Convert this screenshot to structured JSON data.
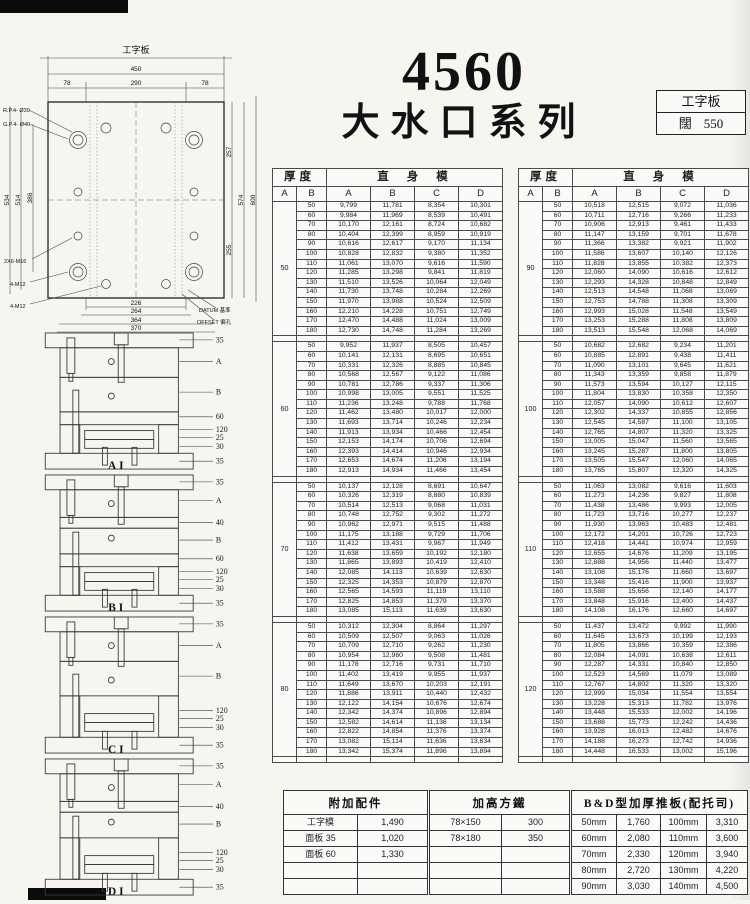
{
  "page_title": {
    "model": "4560",
    "series": "大水口系列"
  },
  "info_box": {
    "type": "工字板",
    "width_label": "闊",
    "width_value": "550"
  },
  "plate_drawing": {
    "title": "工字板",
    "dims_top": [
      "450",
      "78",
      "290",
      "78"
    ],
    "dims_bottom": [
      "226",
      "264",
      "364",
      "370"
    ],
    "dims_left": [
      "534",
      "514",
      "386"
    ],
    "dims_right": [
      "257",
      "255",
      "574",
      "600"
    ],
    "annotations": {
      "return_pin": "R.P.4- Ø30",
      "guide_pin": "G.P.4- Ø40",
      "m16": "2X6-M16",
      "m12_a": "4-M12",
      "m12_b": "4-M12",
      "datum": "DATUM 基準",
      "offset": "OFFSET 偏孔"
    }
  },
  "mold_diagrams": [
    {
      "label": "AI",
      "callouts": [
        "35",
        "A",
        "B",
        "60",
        "120",
        "25",
        "30",
        "35"
      ]
    },
    {
      "label": "BI",
      "callouts": [
        "35",
        "A",
        "40",
        "B",
        "60",
        "120",
        "25",
        "30",
        "35"
      ]
    },
    {
      "label": "CI",
      "callouts": [
        "35",
        "A",
        "B",
        "120",
        "25",
        "30",
        "35"
      ]
    },
    {
      "label": "DI",
      "callouts": [
        "35",
        "A",
        "40",
        "B",
        "120",
        "25",
        "30",
        "35"
      ]
    }
  ],
  "size_tables": [
    {
      "header_thickness": "厚度",
      "header_body": "直身模",
      "col_headers": [
        "A",
        "B",
        "A",
        "B",
        "C",
        "D"
      ],
      "blocks": [
        {
          "a": "50",
          "rows": [
            [
              "50",
              "9,799",
              "11,781",
              "8,354",
              "10,301"
            ],
            [
              "60",
              "9,984",
              "11,969",
              "8,539",
              "10,491"
            ],
            [
              "70",
              "10,170",
              "12,161",
              "8,724",
              "10,682"
            ],
            [
              "80",
              "10,404",
              "12,399",
              "8,959",
              "10,919"
            ],
            [
              "90",
              "10,616",
              "12,617",
              "9,170",
              "11,134"
            ],
            [
              "100",
              "10,828",
              "12,832",
              "9,380",
              "11,352"
            ],
            [
              "110",
              "11,061",
              "13,070",
              "9,616",
              "11,590"
            ],
            [
              "120",
              "11,285",
              "13,298",
              "9,841",
              "11,819"
            ],
            [
              "130",
              "11,510",
              "13,526",
              "10,064",
              "12,049"
            ],
            [
              "140",
              "11,730",
              "13,748",
              "10,284",
              "12,269"
            ],
            [
              "150",
              "11,970",
              "13,988",
              "10,524",
              "12,509"
            ],
            [
              "160",
              "12,210",
              "14,228",
              "10,751",
              "12,749"
            ],
            [
              "170",
              "12,470",
              "14,488",
              "11,024",
              "13,009"
            ],
            [
              "180",
              "12,730",
              "14,748",
              "11,284",
              "13,269"
            ]
          ]
        },
        {
          "a": "60",
          "rows": [
            [
              "50",
              "9,952",
              "11,937",
              "8,505",
              "10,457"
            ],
            [
              "60",
              "10,141",
              "12,131",
              "8,695",
              "10,651"
            ],
            [
              "70",
              "10,331",
              "12,326",
              "8,885",
              "10,845"
            ],
            [
              "80",
              "10,568",
              "12,567",
              "9,122",
              "11,086"
            ],
            [
              "90",
              "10,781",
              "12,786",
              "9,337",
              "11,306"
            ],
            [
              "100",
              "10,998",
              "13,005",
              "9,551",
              "11,525"
            ],
            [
              "110",
              "11,236",
              "13,248",
              "9,788",
              "11,768"
            ],
            [
              "120",
              "11,462",
              "13,480",
              "10,017",
              "12,000"
            ],
            [
              "130",
              "11,693",
              "13,714",
              "10,246",
              "12,234"
            ],
            [
              "140",
              "11,913",
              "13,934",
              "10,466",
              "12,454"
            ],
            [
              "150",
              "12,153",
              "14,174",
              "10,706",
              "12,694"
            ],
            [
              "160",
              "12,393",
              "14,414",
              "10,946",
              "12,934"
            ],
            [
              "170",
              "12,653",
              "14,674",
              "11,206",
              "13,194"
            ],
            [
              "180",
              "12,913",
              "14,934",
              "11,466",
              "13,454"
            ]
          ]
        },
        {
          "a": "70",
          "rows": [
            [
              "50",
              "10,137",
              "12,128",
              "8,691",
              "10,647"
            ],
            [
              "60",
              "10,326",
              "12,319",
              "8,880",
              "10,839"
            ],
            [
              "70",
              "10,514",
              "12,513",
              "9,068",
              "11,031"
            ],
            [
              "80",
              "10,748",
              "12,752",
              "9,302",
              "11,272"
            ],
            [
              "90",
              "10,962",
              "12,971",
              "9,515",
              "11,488"
            ],
            [
              "100",
              "11,175",
              "13,188",
              "9,729",
              "11,706"
            ],
            [
              "110",
              "11,412",
              "13,431",
              "9,967",
              "11,949"
            ],
            [
              "120",
              "11,638",
              "13,659",
              "10,192",
              "12,180"
            ],
            [
              "130",
              "11,865",
              "13,893",
              "10,419",
              "12,410"
            ],
            [
              "140",
              "12,085",
              "14,113",
              "10,639",
              "12,630"
            ],
            [
              "150",
              "12,325",
              "14,353",
              "10,879",
              "12,870"
            ],
            [
              "160",
              "12,565",
              "14,593",
              "11,119",
              "13,110"
            ],
            [
              "170",
              "12,825",
              "14,853",
              "11,379",
              "13,370"
            ],
            [
              "180",
              "13,085",
              "15,113",
              "11,639",
              "13,630"
            ]
          ]
        },
        {
          "a": "80",
          "rows": [
            [
              "50",
              "10,312",
              "12,304",
              "8,864",
              "11,297"
            ],
            [
              "60",
              "10,509",
              "12,507",
              "9,063",
              "11,026"
            ],
            [
              "70",
              "10,709",
              "12,710",
              "9,262",
              "11,230"
            ],
            [
              "80",
              "10,954",
              "12,960",
              "9,508",
              "11,481"
            ],
            [
              "90",
              "11,178",
              "12,716",
              "9,731",
              "11,710"
            ],
            [
              "100",
              "11,402",
              "13,419",
              "9,955",
              "11,937"
            ],
            [
              "110",
              "11,649",
              "13,670",
              "10,203",
              "12,191"
            ],
            [
              "120",
              "11,886",
              "13,911",
              "10,440",
              "12,432"
            ],
            [
              "130",
              "12,122",
              "14,154",
              "10,676",
              "12,674"
            ],
            [
              "140",
              "12,342",
              "14,374",
              "10,896",
              "12,894"
            ],
            [
              "150",
              "12,582",
              "14,614",
              "11,136",
              "13,134"
            ],
            [
              "160",
              "12,822",
              "14,854",
              "11,376",
              "13,374"
            ],
            [
              "170",
              "13,082",
              "15,114",
              "11,636",
              "13,634"
            ],
            [
              "180",
              "13,342",
              "15,374",
              "11,896",
              "13,894"
            ]
          ]
        }
      ]
    },
    {
      "header_thickness": "厚度",
      "header_body": "直身模",
      "col_headers": [
        "A",
        "B",
        "A",
        "B",
        "C",
        "D"
      ],
      "blocks": [
        {
          "a": "90",
          "rows": [
            [
              "50",
              "10,518",
              "12,515",
              "9,072",
              "11,036"
            ],
            [
              "60",
              "10,711",
              "12,716",
              "9,266",
              "11,233"
            ],
            [
              "70",
              "10,906",
              "12,913",
              "9,461",
              "11,433"
            ],
            [
              "80",
              "11,147",
              "13,159",
              "9,701",
              "11,678"
            ],
            [
              "90",
              "11,366",
              "13,382",
              "9,921",
              "11,902"
            ],
            [
              "100",
              "11,586",
              "13,607",
              "10,140",
              "12,126"
            ],
            [
              "110",
              "11,828",
              "13,855",
              "10,382",
              "12,373"
            ],
            [
              "120",
              "12,060",
              "14,090",
              "10,616",
              "12,612"
            ],
            [
              "130",
              "12,293",
              "14,328",
              "10,848",
              "12,849"
            ],
            [
              "140",
              "12,513",
              "14,548",
              "11,068",
              "13,069"
            ],
            [
              "150",
              "12,753",
              "14,788",
              "11,308",
              "13,309"
            ],
            [
              "160",
              "12,993",
              "15,028",
              "11,548",
              "13,549"
            ],
            [
              "170",
              "13,253",
              "15,288",
              "11,808",
              "13,809"
            ],
            [
              "180",
              "13,513",
              "15,548",
              "12,068",
              "14,069"
            ]
          ]
        },
        {
          "a": "100",
          "rows": [
            [
              "50",
              "10,682",
              "12,682",
              "9,234",
              "11,201"
            ],
            [
              "60",
              "10,885",
              "12,891",
              "9,438",
              "11,411"
            ],
            [
              "70",
              "11,090",
              "13,101",
              "9,645",
              "11,621"
            ],
            [
              "80",
              "11,343",
              "13,359",
              "9,858",
              "11,879"
            ],
            [
              "90",
              "11,573",
              "13,594",
              "10,127",
              "12,115"
            ],
            [
              "100",
              "11,804",
              "13,830",
              "10,358",
              "12,350"
            ],
            [
              "110",
              "12,057",
              "14,090",
              "10,612",
              "12,607"
            ],
            [
              "120",
              "12,302",
              "14,337",
              "10,855",
              "12,856"
            ],
            [
              "130",
              "12,545",
              "14,587",
              "11,100",
              "13,105"
            ],
            [
              "140",
              "12,765",
              "14,807",
              "11,320",
              "13,325"
            ],
            [
              "150",
              "13,005",
              "15,047",
              "11,560",
              "13,565"
            ],
            [
              "160",
              "13,245",
              "15,287",
              "11,800",
              "13,805"
            ],
            [
              "170",
              "13,505",
              "15,547",
              "12,060",
              "14,065"
            ],
            [
              "180",
              "13,765",
              "15,807",
              "12,320",
              "14,325"
            ]
          ]
        },
        {
          "a": "110",
          "rows": [
            [
              "50",
              "11,063",
              "13,082",
              "9,616",
              "11,603"
            ],
            [
              "60",
              "11,273",
              "14,236",
              "9,827",
              "11,808"
            ],
            [
              "70",
              "11,438",
              "13,486",
              "9,993",
              "12,005"
            ],
            [
              "80",
              "11,723",
              "13,716",
              "10,277",
              "12,237"
            ],
            [
              "90",
              "11,930",
              "13,963",
              "10,483",
              "12,481"
            ],
            [
              "100",
              "12,172",
              "14,201",
              "10,726",
              "12,723"
            ],
            [
              "110",
              "12,418",
              "14,441",
              "10,974",
              "12,959"
            ],
            [
              "120",
              "12,655",
              "14,676",
              "11,209",
              "13,195"
            ],
            [
              "130",
              "12,888",
              "14,956",
              "11,440",
              "13,477"
            ],
            [
              "140",
              "13,108",
              "15,176",
              "11,660",
              "13,697"
            ],
            [
              "150",
              "13,348",
              "15,416",
              "11,900",
              "13,937"
            ],
            [
              "160",
              "13,588",
              "15,656",
              "12,140",
              "14,177"
            ],
            [
              "170",
              "13,848",
              "15,916",
              "12,400",
              "14,437"
            ],
            [
              "180",
              "14,108",
              "16,176",
              "12,660",
              "14,697"
            ]
          ]
        },
        {
          "a": "120",
          "rows": [
            [
              "50",
              "11,437",
              "13,472",
              "9,992",
              "11,990"
            ],
            [
              "60",
              "11,645",
              "13,673",
              "10,199",
              "12,193"
            ],
            [
              "70",
              "11,805",
              "13,866",
              "10,359",
              "12,386"
            ],
            [
              "80",
              "12,084",
              "14,091",
              "10,638",
              "12,611"
            ],
            [
              "90",
              "12,287",
              "14,331",
              "10,840",
              "12,850"
            ],
            [
              "100",
              "12,523",
              "14,569",
              "11,079",
              "13,089"
            ],
            [
              "110",
              "12,767",
              "14,802",
              "11,320",
              "13,320"
            ],
            [
              "120",
              "12,999",
              "15,034",
              "11,554",
              "13,554"
            ],
            [
              "130",
              "13,228",
              "15,313",
              "11,782",
              "13,976"
            ],
            [
              "140",
              "13,448",
              "15,533",
              "12,002",
              "14,196"
            ],
            [
              "150",
              "13,688",
              "15,773",
              "12,242",
              "14,436"
            ],
            [
              "160",
              "13,928",
              "16,013",
              "12,482",
              "14,676"
            ],
            [
              "170",
              "14,188",
              "16,273",
              "12,742",
              "14,936"
            ],
            [
              "180",
              "14,448",
              "16,533",
              "13,002",
              "15,196"
            ]
          ]
        }
      ]
    }
  ],
  "accessories_table": {
    "title": "附加配件",
    "rows": [
      [
        "工字模",
        "1,490"
      ],
      [
        "面板 35",
        "1,020"
      ],
      [
        "面板 60",
        "1,330"
      ],
      [
        "",
        ""
      ],
      [
        "",
        ""
      ]
    ]
  },
  "riser_table": {
    "title": "加高方鐵",
    "rows": [
      [
        "78×150",
        "300"
      ],
      [
        "78×180",
        "350"
      ],
      [
        "",
        ""
      ],
      [
        "",
        ""
      ],
      [
        "",
        ""
      ]
    ]
  },
  "bd_table": {
    "title": "B&D型加厚推板(配托司)",
    "rows": [
      [
        "50mm",
        "1,760",
        "100mm",
        "3,310"
      ],
      [
        "60mm",
        "2,080",
        "110mm",
        "3,600"
      ],
      [
        "70mm",
        "2,330",
        "120mm",
        "3,940"
      ],
      [
        "80mm",
        "2,720",
        "130mm",
        "4,220"
      ],
      [
        "90mm",
        "3,030",
        "140mm",
        "4,500"
      ]
    ]
  }
}
